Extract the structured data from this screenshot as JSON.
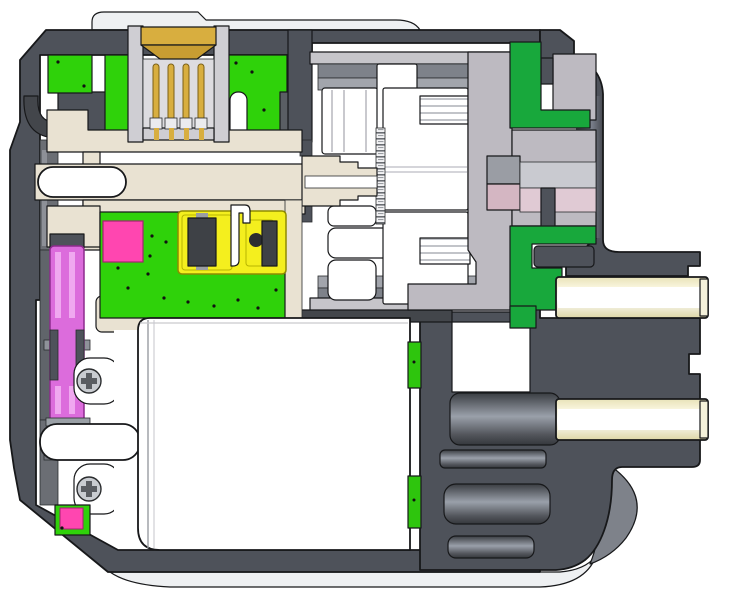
{
  "diagram": {
    "type": "cad-cross-section",
    "subject": "servo-actuator-cutaway",
    "canvas_width": "737",
    "canvas_height": "592"
  },
  "colors": {
    "bg": "#ffffff",
    "panel": "#eef0f2",
    "housing": "#4e525a",
    "housing_deep": "#43464b",
    "housing_mid": "#5a5e64",
    "liner": "#6b6e74",
    "liner_hi": "#8d9097",
    "shell": "#cfced3",
    "cavity": "#dddce0",
    "shell_bar": "#c6c5ca",
    "ring_dark": "#7e828a",
    "ring_light": "#a2a5ac",
    "carrier": "#bdbac1",
    "block_gray": "#9a9da4",
    "block_pink": "#d4b6c2",
    "block_gray_lt": "#c9cad0",
    "block_pink_lt": "#e0cad4",
    "pcb_green": "#2fd20a",
    "seal_green": "#18a83c",
    "strip_green": "#2ec50d",
    "gold": "#d8ae3f",
    "gold_dark": "#c89d32",
    "cream": "#e9e2d2",
    "bore_white": "#ffffff",
    "magenta": "#dc6cdc",
    "magenta_hi": "#f0a8f0",
    "pink_bright": "#ff46b0",
    "yellow": "#f4ef1e",
    "chip": "#3e4146",
    "screw": "#c9ccd1",
    "motor_white": "#ffffff",
    "curve_gray": "#7e828a"
  },
  "parts": [
    {
      "name": "outer-housing-section"
    },
    {
      "name": "top-cover-surface"
    },
    {
      "name": "bottom-cover-surface"
    },
    {
      "name": "four-pin-connector"
    },
    {
      "name": "connector-pins-gold"
    },
    {
      "name": "upper-pcb-green"
    },
    {
      "name": "main-pcb-green"
    },
    {
      "name": "smd-chips"
    },
    {
      "name": "yellow-sensor-module"
    },
    {
      "name": "encoder-magnet-pink"
    },
    {
      "name": "magenta-idler-spool"
    },
    {
      "name": "cream-chassis-bracket"
    },
    {
      "name": "main-shaft-bore"
    },
    {
      "name": "planetary-geartrain"
    },
    {
      "name": "sun-gear-teeth"
    },
    {
      "name": "output-carrier"
    },
    {
      "name": "green-output-seals"
    },
    {
      "name": "motor-can"
    },
    {
      "name": "mounting-screws"
    },
    {
      "name": "cable-bushing-upper"
    },
    {
      "name": "cable-bushing-lower"
    },
    {
      "name": "rear-boss-cylinders"
    }
  ]
}
